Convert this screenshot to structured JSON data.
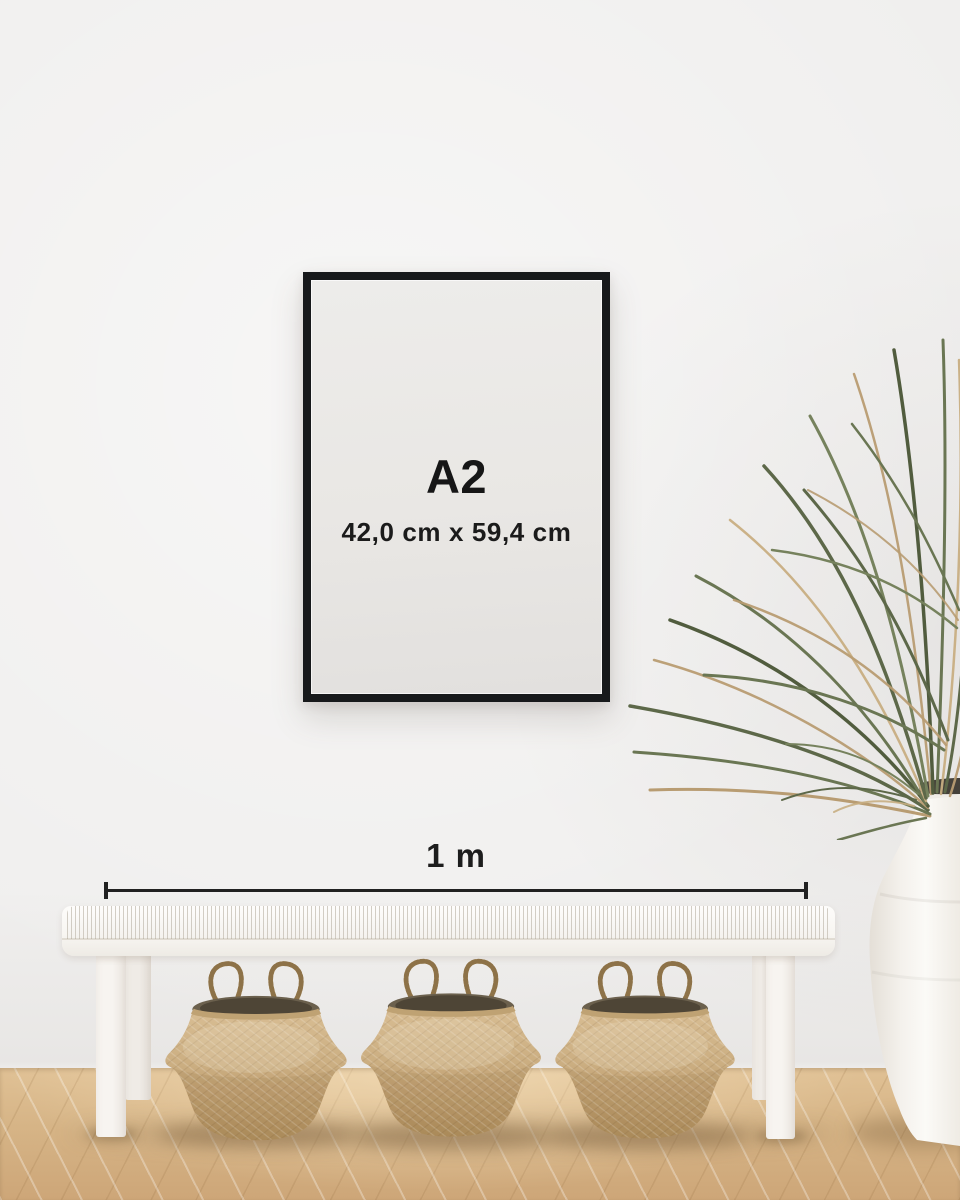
{
  "scene": {
    "description": "Poster size guide mockup: black A2 frame on a wall above a white woven bench with three seagrass belly baskets, a dried palm plant in a white ceramic floor vase, on a light oak herringbone floor",
    "poster": {
      "size_label": "A2",
      "dimensions_label": "42,0 cm x 59,4 cm"
    },
    "scale": {
      "label": "1 m"
    },
    "colors": {
      "wall": "#f0efee",
      "frame_black": "#17191b",
      "poster_bg": "#e9e7e4",
      "ink": "#161616",
      "floor_light": "#e0c195",
      "floor_dark": "#cda678",
      "basket_tan": "#c9ab7e",
      "basket_dark": "#b1905f",
      "leaf_green": "#5d6849",
      "leaf_dry": "#b89c72",
      "bench_white": "#f8f6f2",
      "vase_white": "#f6f3ef"
    }
  }
}
